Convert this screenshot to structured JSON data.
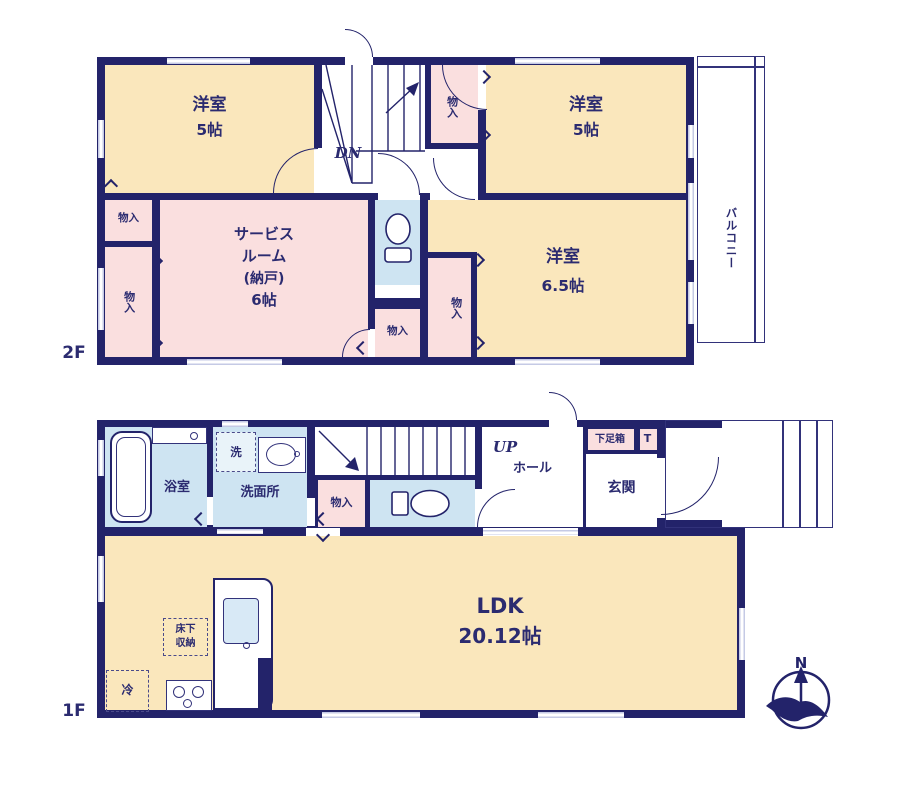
{
  "colors": {
    "wall": "#23236A",
    "room_cream": "#FAE7BC",
    "room_pink": "#FADFDF",
    "room_blue": "#CEE4F2",
    "window": "#C5CAE5",
    "text": "#2B2B70"
  },
  "floor2": {
    "label": "2F",
    "room_west": {
      "name": "洋室",
      "size": "5帖"
    },
    "room_east": {
      "name": "洋室",
      "size": "5帖"
    },
    "room_southeast": {
      "name": "洋室",
      "size": "6.5帖"
    },
    "service_room": {
      "lines": [
        "サービス",
        "ルーム",
        "(納戸)",
        "6帖"
      ]
    },
    "balcony": "バルコニー",
    "stairs": "DN",
    "closet": "物入"
  },
  "floor1": {
    "label": "1F",
    "bath": "浴室",
    "washer": "洗",
    "washroom": "洗面所",
    "closet": "物入",
    "stairs": "UP",
    "hall": "ホール",
    "shoe_cabinet": "下足箱",
    "shoe_cabinet_t": "T",
    "entrance": "玄関",
    "ldk": {
      "name": "LDK",
      "size": "20.12帖"
    },
    "underfloor_storage": {
      "lines": [
        "床下",
        "収納"
      ]
    },
    "refrigerator": "冷"
  },
  "compass": {
    "north": "N"
  }
}
